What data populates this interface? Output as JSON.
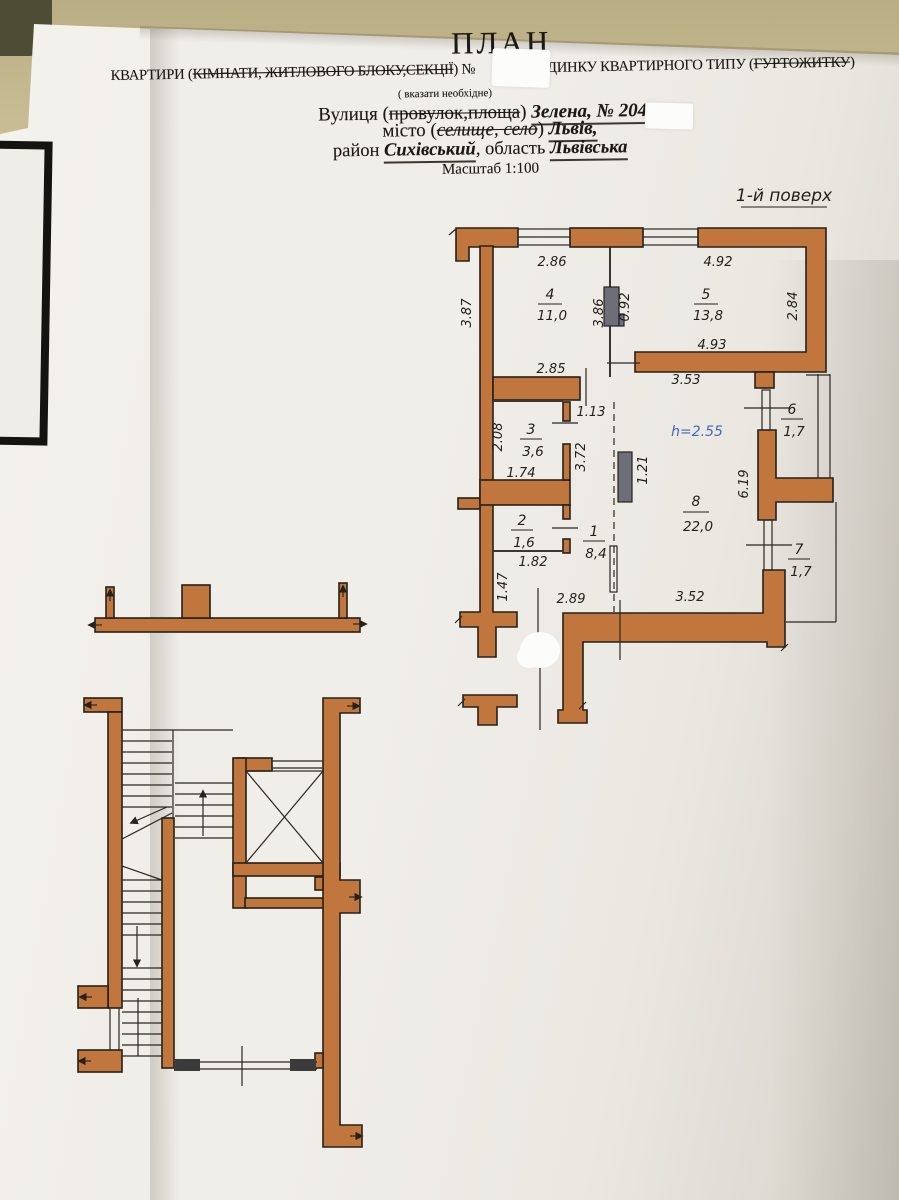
{
  "header": {
    "title": "ПЛАН",
    "line2": {
      "t1": "КВАРТИРИ (",
      "t2": "КІМНАТИ, ЖИТЛОВОГО БЛОКУ,СЕКЦІЇ",
      "t3": ") № ",
      "t4": "БУДИНКУ КВАРТИРНОГО ТИПУ (",
      "t5": "ГУРТОЖИТКУ",
      "t6": ")"
    },
    "clarify": "( вказати необхідне)",
    "street": {
      "t1": "Вулиця (",
      "t2": "провулок,площа",
      "t3": ") ",
      "t4": "Зелена, № 204"
    },
    "city": {
      "t1": "місто (",
      "t2": "селище, село",
      "t3": ") ",
      "t4": "Львів,"
    },
    "district": {
      "t1": "район ",
      "t2": "Сихівський",
      "t3": ", область ",
      "t4": "Львівська"
    },
    "scale": "Масштаб 1:100"
  },
  "plan": {
    "floor_label": "1-й поверх",
    "height_note": "h=2.55",
    "rooms": {
      "r1": {
        "no": "1",
        "area": "8,4"
      },
      "r2": {
        "no": "2",
        "area": "1,6"
      },
      "r3": {
        "no": "3",
        "area": "3,6"
      },
      "r4": {
        "no": "4",
        "area": "11,0"
      },
      "r5": {
        "no": "5",
        "area": "13,8"
      },
      "r6": {
        "no": "6",
        "area": "1,7"
      },
      "r7": {
        "no": "7",
        "area": "1,7"
      },
      "r8": {
        "no": "8",
        "area": "22,0"
      }
    },
    "dims": {
      "top_room4": "2.86",
      "top_room5": "4.92",
      "left_room4": "3.87",
      "mid_room4": "3.86",
      "vent": "0.92",
      "right_room5": "2.84",
      "bottom_room4": "2.85",
      "bottom_room5": "4.93",
      "top_room8": "3.53",
      "door_hall": "1.13",
      "left_room3": "2.08",
      "bottom_room3": "1.74",
      "hall_left": "3.72",
      "hall_vent": "1.21",
      "right_room8": "6.19",
      "bottom_room2": "1.82",
      "entry_left": "1.47",
      "bottom_hall": "2.89",
      "bottom_room8": "3.52"
    }
  },
  "colors": {
    "wall_fill": "#c1763e",
    "wall_outline": "#26211a",
    "vent_fill": "#6e6e78",
    "height_note_text": "#3f68b6",
    "paper": "#edebe6",
    "background": "#c3b88c",
    "ink": "#24201a"
  }
}
